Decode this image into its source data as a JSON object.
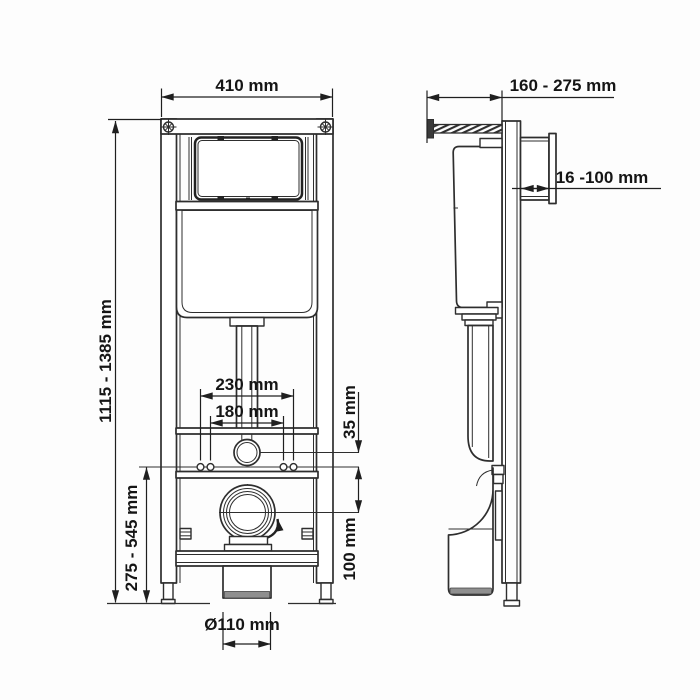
{
  "labels": {
    "frame_width": "410 mm",
    "install_depth": "160 - 275 mm",
    "plate_recess": "16 -100 mm",
    "frame_height": "1115 - 1385 mm",
    "fixing_span_outer": "230 mm",
    "fixing_span_inner": "180 mm",
    "supply_offset": "35 mm",
    "drain_offset": "100 mm",
    "drain_height": "275 - 545 mm",
    "drain_diameter": "Ø110 mm"
  },
  "colors": {
    "line": "#2e2e2e",
    "text": "#151515",
    "pipe_shade": "#8f8f8f",
    "background": "#fdfdfd"
  }
}
